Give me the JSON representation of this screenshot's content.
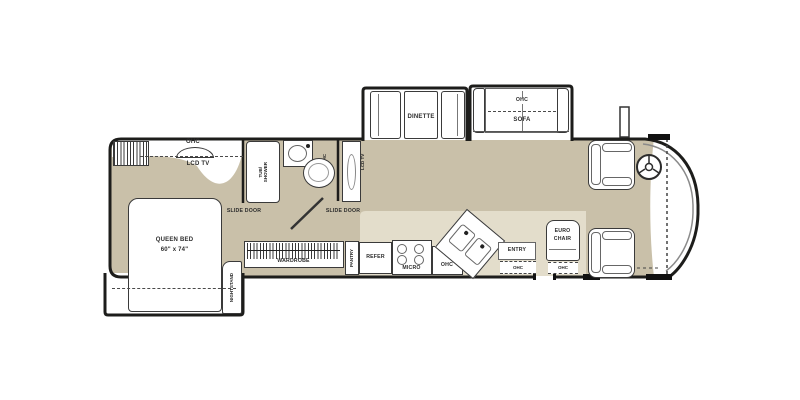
{
  "plan": {
    "bedroom": {
      "closet_ohc": "OHC",
      "lcd_tv": "LCD TV",
      "bed_line1": "QUEEN BED",
      "bed_line2": "60\" x 74\"",
      "nightstand": "NIGHTSTAND",
      "slide_door": "SLIDE DOOR"
    },
    "bath": {
      "tub_line1": "TUB/",
      "tub_line2": "SHOWER",
      "ohc": "OHC",
      "lcd_tv": "LCD TV",
      "slide_door": "SLIDE DOOR"
    },
    "kitchen": {
      "wardrobe": "WARDROBE",
      "pantry": "PANTRY",
      "refer": "REFER",
      "micro": "MICRO",
      "ohc": "OHC"
    },
    "living": {
      "dinette": "DINETTE",
      "sofa": "SOFA",
      "sofa_ohc": "OHC"
    },
    "entry": {
      "label": "ENTRY",
      "ohc": "OHC"
    },
    "euro": {
      "line1": "EURO",
      "line2": "CHAIR",
      "ohc": "OHC"
    }
  },
  "colors": {
    "floor_main": "#c9c0a9",
    "floor_galley": "#e3ddcb",
    "wall": "#1d1d1b",
    "slide_floor": "#ffffff"
  }
}
